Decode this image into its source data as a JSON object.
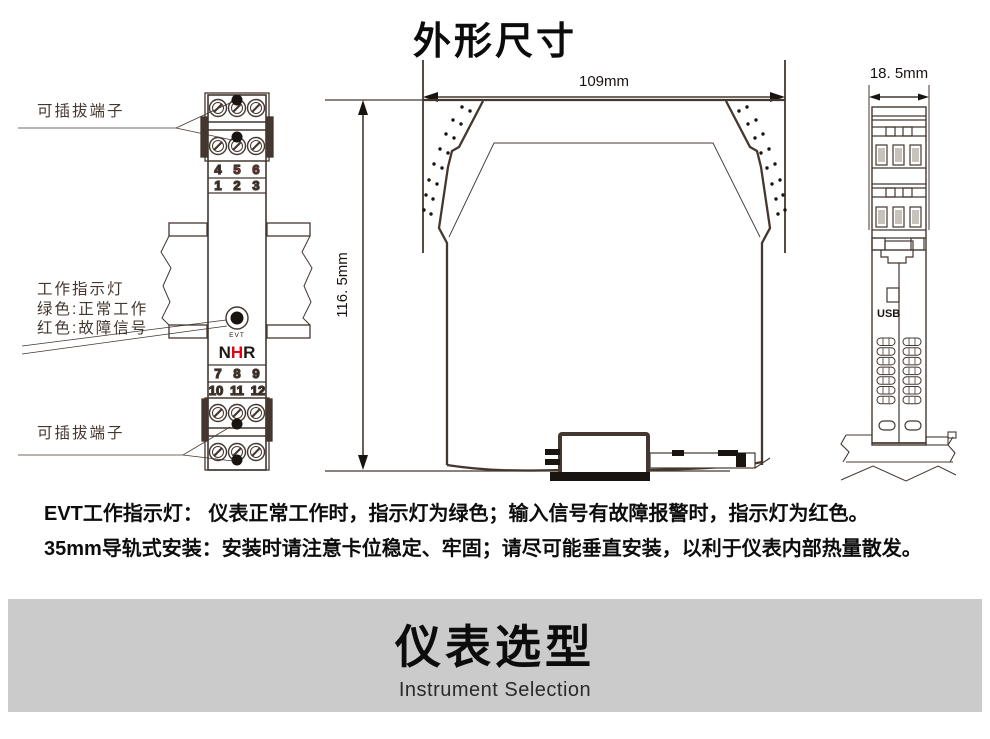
{
  "title": "外形尺寸",
  "front_view": {
    "label_terminal_top": "可插拔端子",
    "label_terminal_bottom": "可插拔端子",
    "indicator_label_line1": "工作指示灯",
    "indicator_label_line2": "绿色:正常工作",
    "indicator_label_line3": "红色:故障信号",
    "terminal_numbers": {
      "row1": [
        "4",
        "5",
        "6"
      ],
      "row2": [
        "1",
        "2",
        "3"
      ],
      "row3": [
        "7",
        "8",
        "9"
      ],
      "row4": [
        "10",
        "11",
        "12"
      ]
    },
    "evt_label": "EVT",
    "logo_letters": [
      "N",
      "H",
      "R"
    ]
  },
  "side_view": {
    "width_dim": "109mm",
    "height_dim": "116. 5mm"
  },
  "end_view": {
    "width_dim": "18. 5mm",
    "usb_label": "USB"
  },
  "notes": [
    "EVT工作指示灯： 仪表正常工作时，指示灯为绿色；输入信号有故障报警时，指示灯为红色。",
    "35mm导轨式安装：安装时请注意卡位稳定、牢固；请尽可能垂直安装，以利于仪表内部热量散发。"
  ],
  "banner": {
    "title": "仪表选型",
    "subtitle": "Instrument Selection"
  },
  "colors": {
    "line": "#44372f",
    "red": "#e60012",
    "banner_bg": "#cbcbcb"
  }
}
